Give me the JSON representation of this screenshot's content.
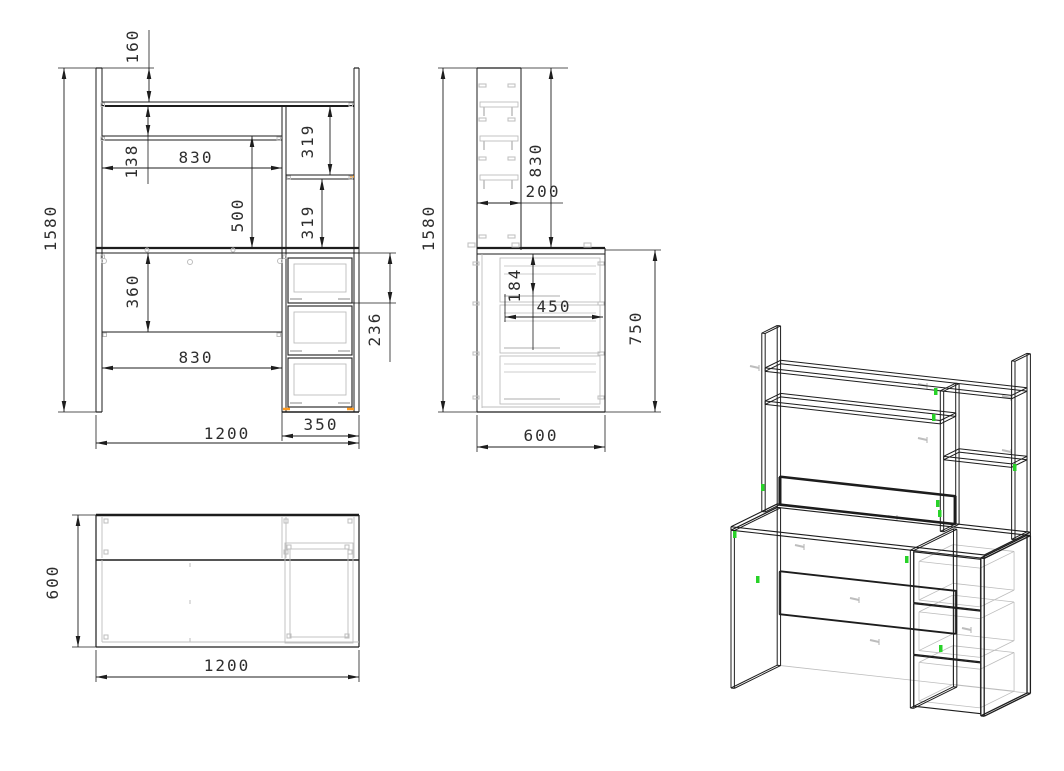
{
  "drawing": {
    "kind": "furniture-dimension-drawing",
    "views": {
      "front": {
        "dims": {
          "top_offset": "160",
          "total_height": "1580",
          "shelf_gap": "138",
          "inner_width": "830",
          "niche_height": "500",
          "shelf_upper": "319",
          "shelf_lower": "319",
          "under_desktop": "360",
          "inner_width_lower": "830",
          "total_width": "1200",
          "pedestal_width": "350",
          "drawer_front": "236"
        }
      },
      "side": {
        "dims": {
          "total_height": "1580",
          "hutch_height": "830",
          "hutch_depth": "200",
          "drawer_offset": "184",
          "drawer_depth": "450",
          "desk_height": "750",
          "total_depth": "600"
        }
      },
      "top": {
        "dims": {
          "depth": "600",
          "width": "1200"
        }
      }
    },
    "colors": {
      "line": "#1d1d1d",
      "hidden": "#bdbdbd",
      "accent_orange": "#ff9a1e",
      "accent_green": "#28d228",
      "background": "#ffffff"
    }
  }
}
